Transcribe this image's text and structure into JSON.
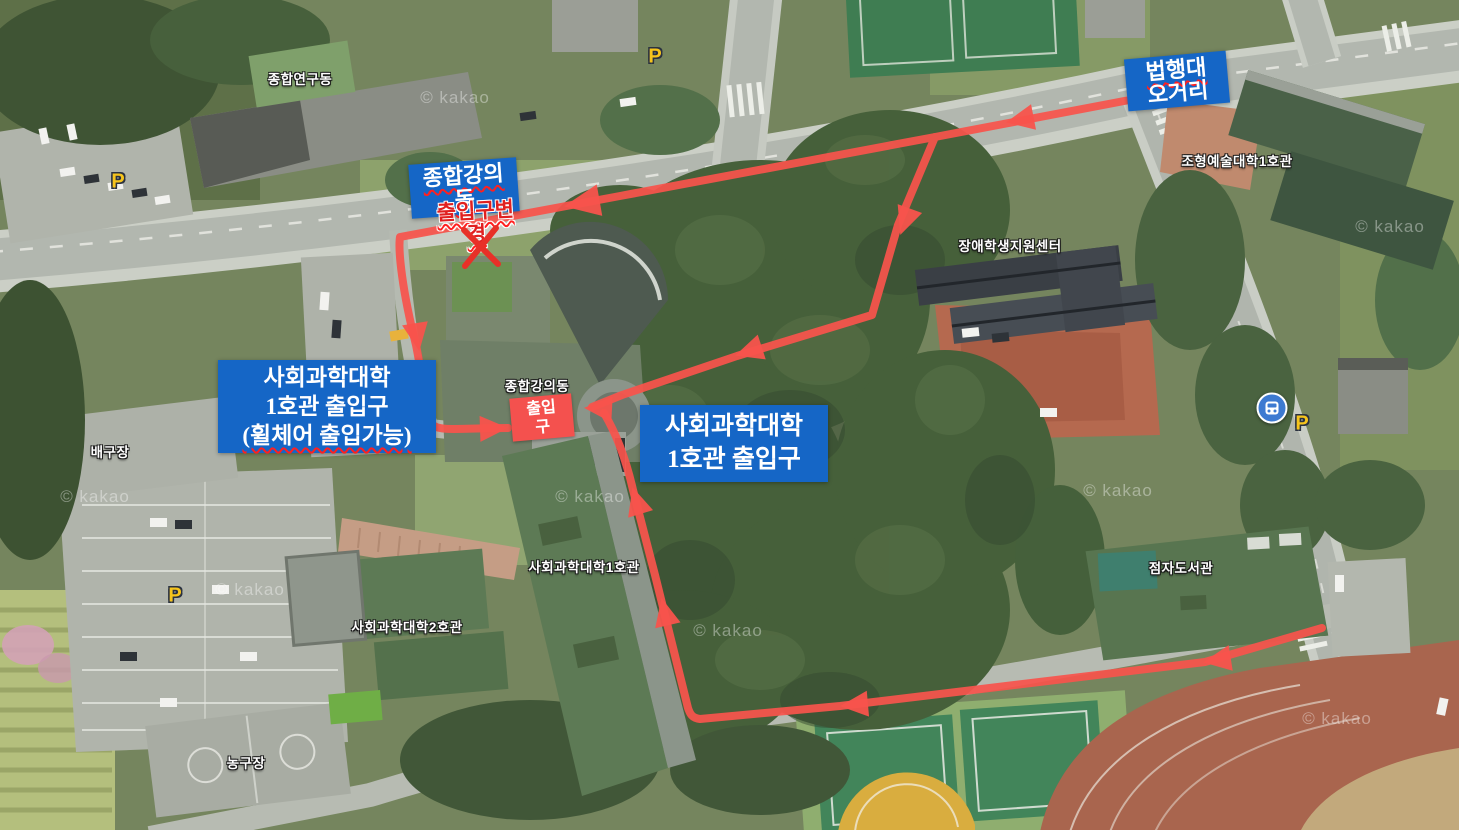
{
  "attribution": "© kakao",
  "colors": {
    "label_blue": "#1566c6",
    "route_red": "#f8544c",
    "warning_red": "#e02020",
    "entrance_box_red": "#f4514e",
    "parking_yellow": "#f6c41c",
    "bus_stop_blue": "#3d7ad1"
  },
  "annotations": {
    "top_right_label": {
      "line1": "법행대",
      "line2": "오거리"
    },
    "lecture_hall_label": {
      "line1": "종합강의",
      "line2": "동"
    },
    "entrance_changed": {
      "line1": "출입구변",
      "line2": "경"
    },
    "left_label": {
      "line1": "사회과학대학",
      "line2": "1호관 출입구",
      "line3": "(휠체어 출입가능)"
    },
    "center_label": {
      "line1": "사회과학대학",
      "line2": "1호관 출입구"
    },
    "entrance_box": {
      "line1": "출입",
      "line2": "구"
    }
  },
  "map_labels": {
    "research_bldg": "종합연구동",
    "fine_arts_bldg": "조형예술대학1호관",
    "disability_center": "장애학생지원센터",
    "lecture_hall": "종합강의동",
    "social_sci_1": "사회과학대학1호관",
    "social_sci_2": "사회과학대학2호관",
    "braille_library": "점자도서관",
    "volleyball_court": "배구장",
    "basketball_court": "농구장"
  },
  "markers": {
    "parking": "P"
  }
}
